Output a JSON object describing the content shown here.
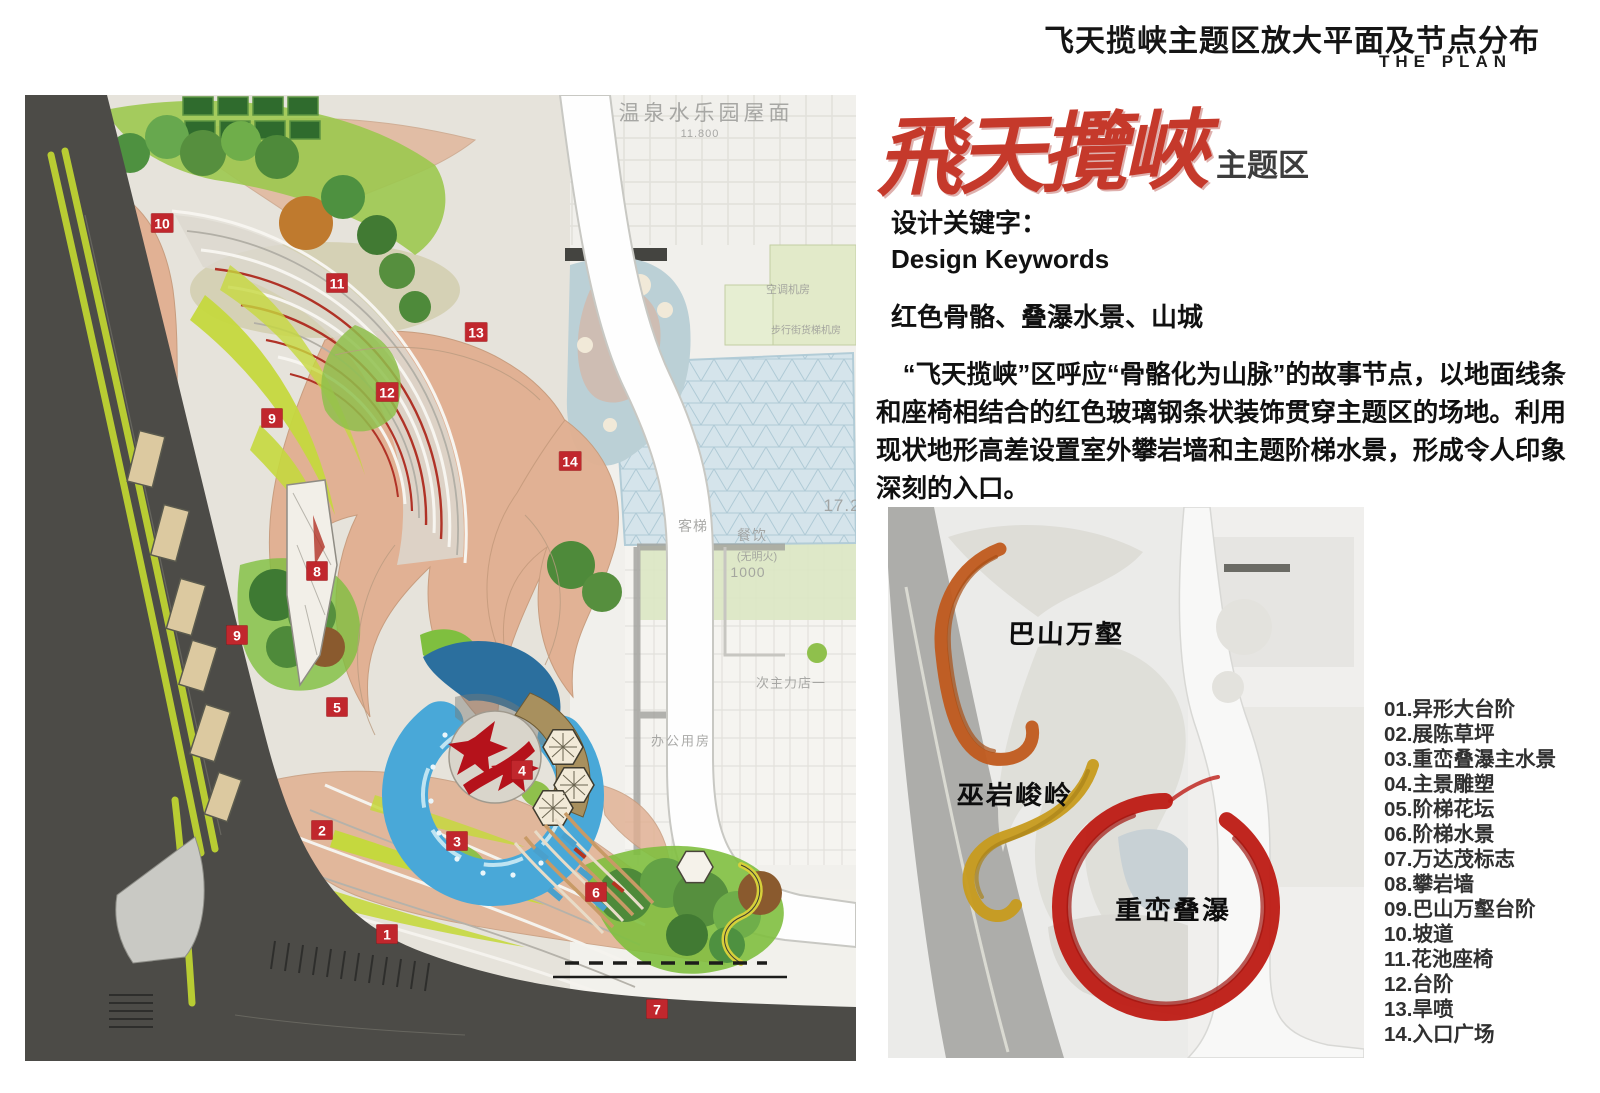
{
  "header": {
    "title": "飞天揽峡主题区放大平面及节点分布",
    "subtitle": "THE PLAN"
  },
  "theme_title": {
    "calligraphy": "飛天攬峽",
    "zone_label": "主题区"
  },
  "keywords": {
    "label_zh": "设计关键字：",
    "label_en": "Design Keywords",
    "value": "红色骨骼、叠瀑水景、山城"
  },
  "description": "“飞天揽峡”区呼应“骨骼化为山脉”的故事节点，以地面线条和座椅相结合的红色玻璃钢条状装饰贯穿主题区的场地。利用现状地形高差设置室外攀岩墙和主题阶梯水景，形成令人印象深刻的入口。",
  "legend": [
    "01.异形大台阶",
    "02.展陈草坪",
    "03.重峦叠瀑主水景",
    "04.主景雕塑",
    "05.阶梯花坛",
    "06.阶梯水景",
    "07.万达茂标志",
    "08.攀岩墙",
    "09.巴山万壑台阶",
    "10.坡道",
    "11.花池座椅",
    "12.台阶",
    "13.旱喷",
    "14.入口广场"
  ],
  "plan": {
    "markers": [
      {
        "n": "10",
        "x": 162,
        "y": 223
      },
      {
        "n": "11",
        "x": 337,
        "y": 283
      },
      {
        "n": "13",
        "x": 476,
        "y": 332
      },
      {
        "n": "12",
        "x": 387,
        "y": 392
      },
      {
        "n": "9",
        "x": 272,
        "y": 418
      },
      {
        "n": "14",
        "x": 570,
        "y": 461
      },
      {
        "n": "8",
        "x": 317,
        "y": 571
      },
      {
        "n": "9",
        "x": 237,
        "y": 635
      },
      {
        "n": "5",
        "x": 337,
        "y": 707
      },
      {
        "n": "4",
        "x": 522,
        "y": 770
      },
      {
        "n": "2",
        "x": 322,
        "y": 830
      },
      {
        "n": "3",
        "x": 457,
        "y": 841
      },
      {
        "n": "6",
        "x": 596,
        "y": 892
      },
      {
        "n": "1",
        "x": 387,
        "y": 934
      },
      {
        "n": "7",
        "x": 657,
        "y": 1009
      }
    ],
    "faint_labels": [
      {
        "t": "温泉水乐园屋面",
        "x": 706,
        "y": 112,
        "s": 21,
        "ls": 4
      },
      {
        "t": "11.800",
        "x": 700,
        "y": 134,
        "s": 11,
        "ls": 1
      },
      {
        "t": "空调机房",
        "x": 788,
        "y": 289,
        "s": 11,
        "ls": 0
      },
      {
        "t": "步行街货梯机房",
        "x": 806,
        "y": 329,
        "s": 10,
        "ls": 0
      },
      {
        "t": "客梯",
        "x": 693,
        "y": 526,
        "s": 14,
        "ls": 1
      },
      {
        "t": "餐饮",
        "x": 752,
        "y": 535,
        "s": 14,
        "ls": 1
      },
      {
        "t": "(无明火)",
        "x": 757,
        "y": 556,
        "s": 11,
        "ls": 0
      },
      {
        "t": "1000",
        "x": 748,
        "y": 572,
        "s": 14,
        "ls": 1
      },
      {
        "t": "17.2",
        "x": 842,
        "y": 506,
        "s": 17,
        "ls": 1
      },
      {
        "t": "办公用房",
        "x": 681,
        "y": 740,
        "s": 13,
        "ls": 2
      },
      {
        "t": "次主力店一",
        "x": 791,
        "y": 682,
        "s": 13,
        "ls": 1
      }
    ]
  },
  "inset": {
    "labels": [
      {
        "text": "巴山万壑",
        "x": 178,
        "y": 125
      },
      {
        "text": "巫岩峻岭",
        "x": 127,
        "y": 286
      },
      {
        "text": "重峦叠瀑",
        "x": 285,
        "y": 401
      }
    ],
    "stroke_colors": {
      "orange": "#c05a1d",
      "gold": "#c79b1e",
      "red": "#bd1d16"
    }
  },
  "colors": {
    "accent_red": "#c1272d",
    "calligraphy_red": "#c5392b",
    "road": "#4c4b47",
    "lime_line": "#b8cc33",
    "water": "#49a8d8",
    "salmon": "#e0b092"
  }
}
